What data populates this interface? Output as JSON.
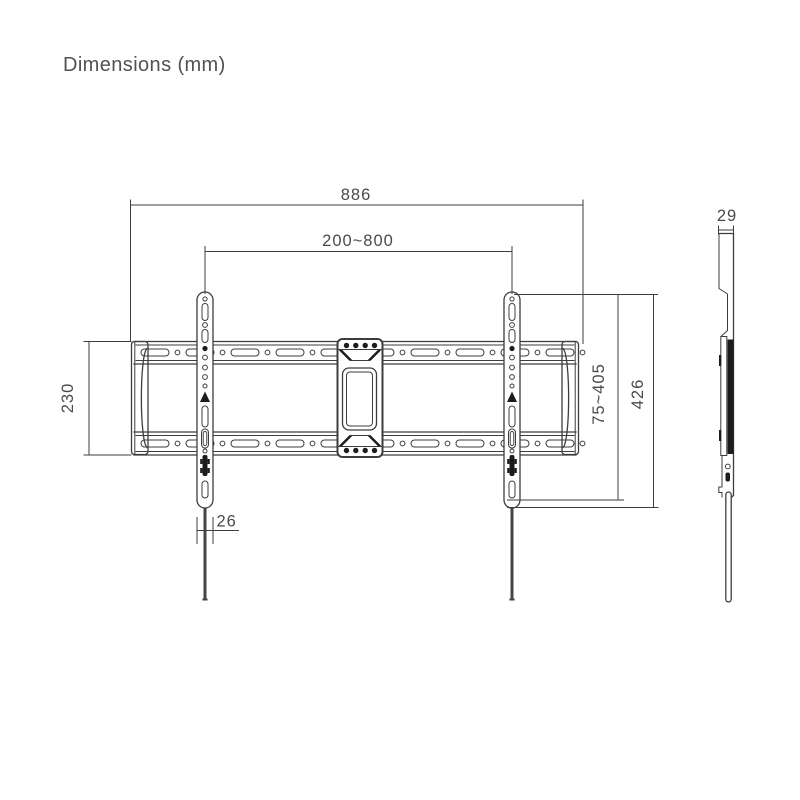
{
  "title": "Dimensions (mm)",
  "unit": "mm",
  "drawing": {
    "type": "tv-wall-mount-technical-drawing",
    "views": [
      "front-view",
      "side-view"
    ]
  },
  "dimensions": {
    "overall_width": "886",
    "vesa_width_range": "200~800",
    "wall_plate_height": "230",
    "rail_width": "26",
    "vesa_height_range": "75~405",
    "rail_height": "426",
    "side_depth": "29"
  },
  "colors": {
    "line": "#3d3d3d",
    "dark_fill": "#1c1c1c",
    "text": "#4a4a4a",
    "background": "#ffffff"
  }
}
